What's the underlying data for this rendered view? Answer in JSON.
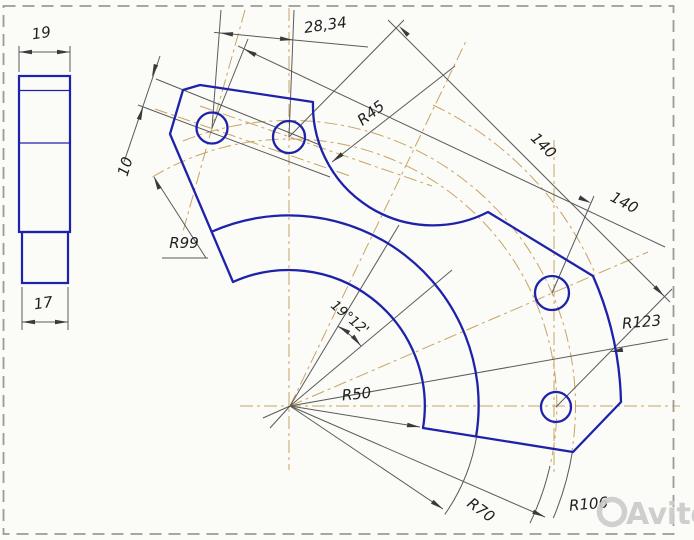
{
  "drawing_title": "bracket-plate-cad-drawing",
  "labels": {
    "d19": "19",
    "d17": "17",
    "d10": "10",
    "d2834": "28,34",
    "r45": "R45",
    "d140a": "140",
    "d140b": "140",
    "r99": "R99",
    "angle": "19°12'",
    "r50": "R50",
    "r70": "R70",
    "r123": "R123",
    "r106": "R106"
  },
  "watermark": {
    "label": "Avito"
  },
  "colors": {
    "outline_blue": "#1e22aa",
    "centerline_tan": "#c9a365",
    "dimension_gray": "#5a5a5a",
    "border_dash_gray": "#9b9b9b",
    "text": "#202020",
    "watermark_gray": "#cbcbcb",
    "background": "#fbfbf8"
  }
}
